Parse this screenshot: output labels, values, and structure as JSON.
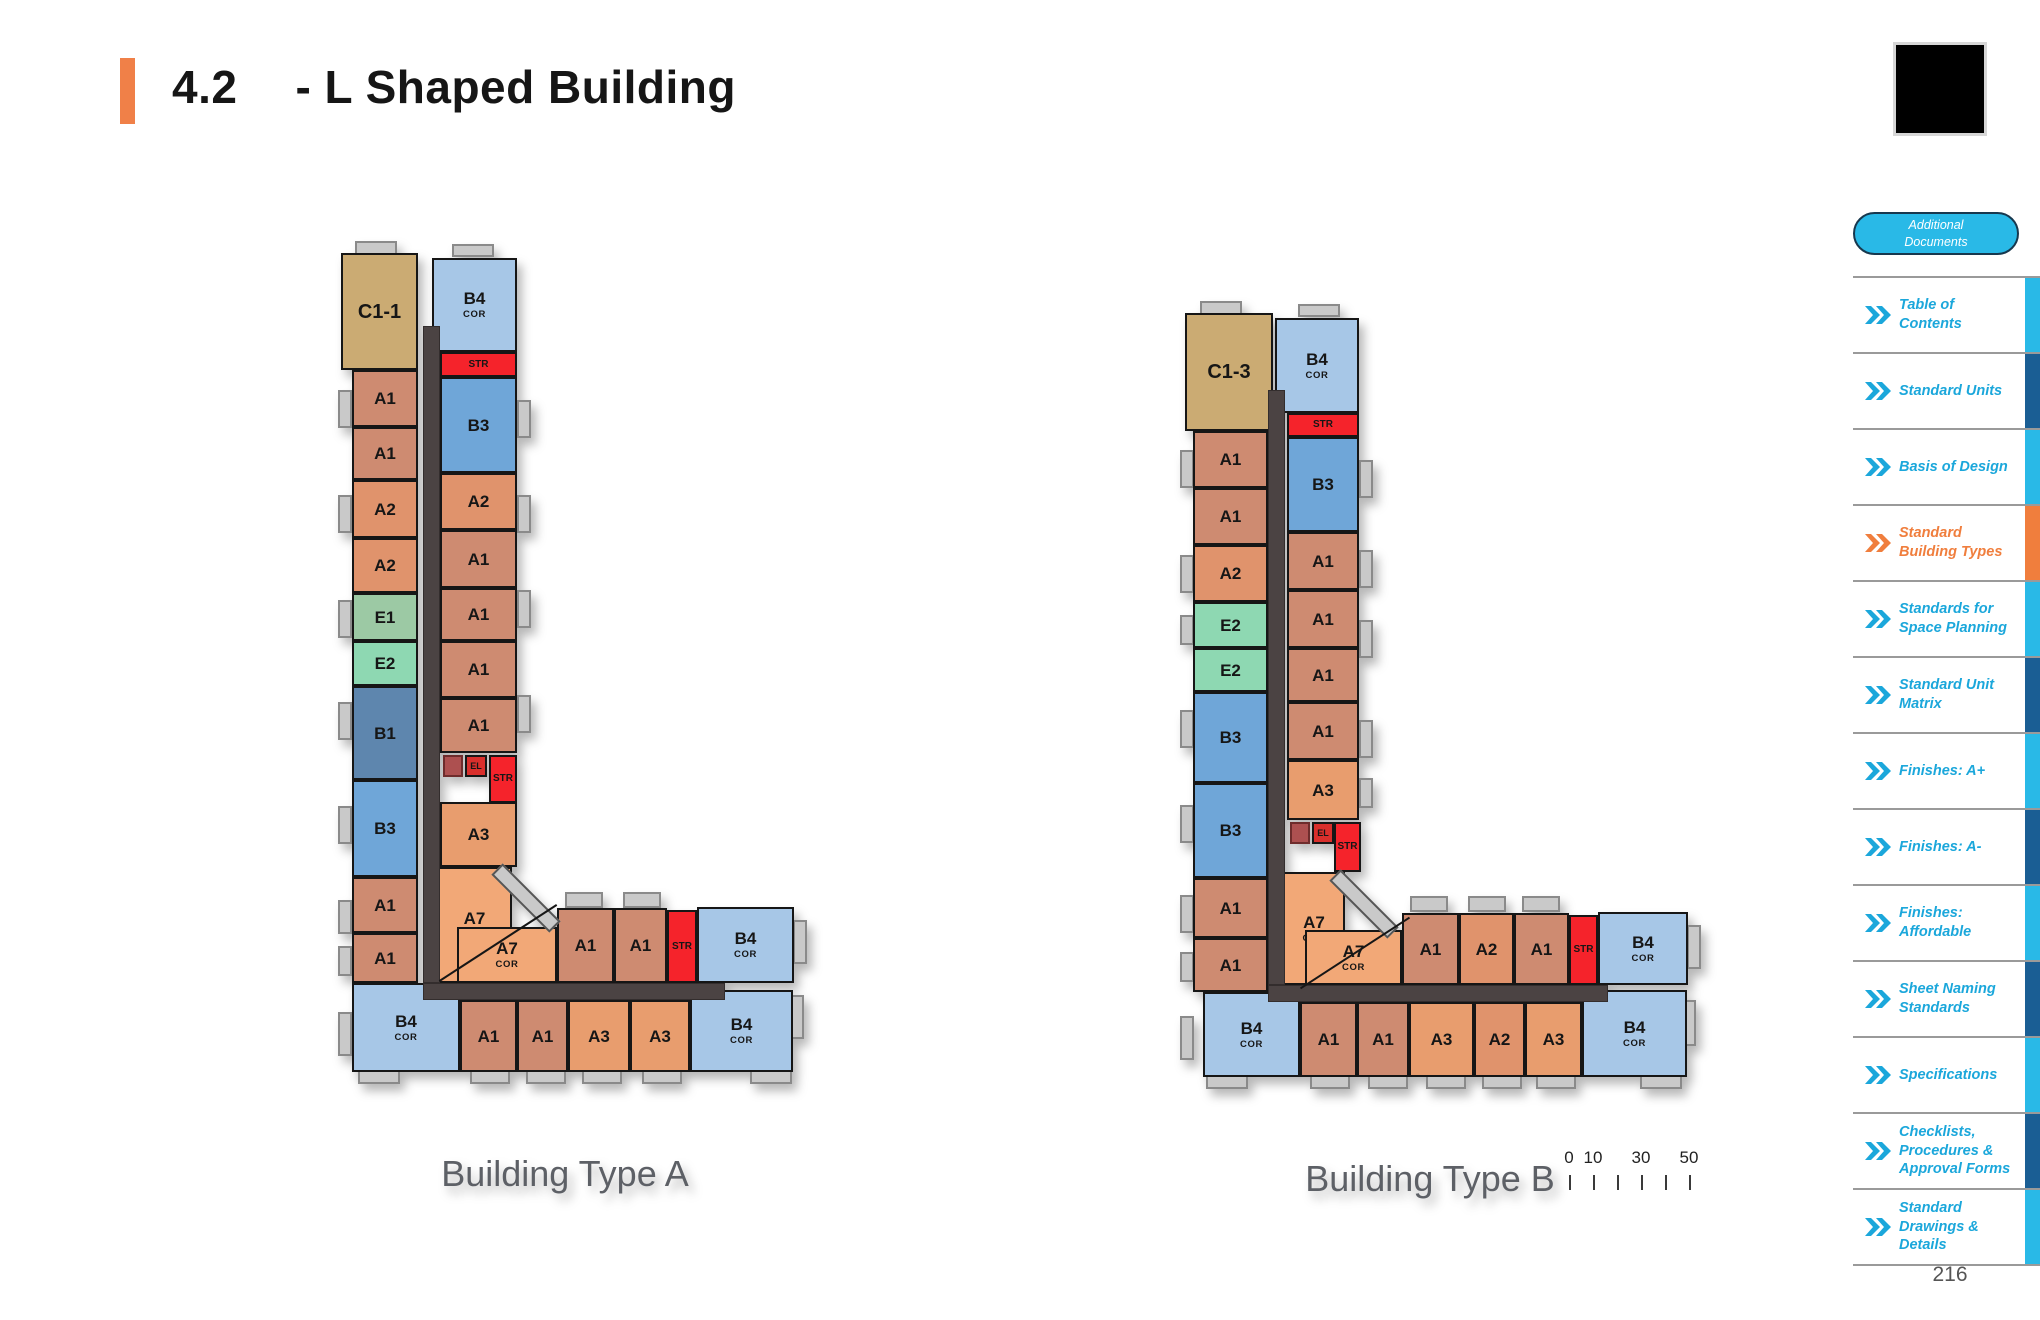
{
  "header": {
    "section": "4.2",
    "title": "- L Shaped Building"
  },
  "page_number": "216",
  "palette": {
    "A1": "#ce8b71",
    "A2": "#e0936c",
    "A3": "#e89d6e",
    "A7": "#f2a877",
    "B1": "#5e86ae",
    "B3": "#6fa6d8",
    "B4": "#a7c7e7",
    "C1": "#cbab73",
    "E1": "#9cc9a4",
    "E2": "#8ed8b2",
    "STR": "#f5232b",
    "EL": "#d92f2c",
    "ELX": "#ad5050",
    "COR": "#4b4343",
    "DECK": "#c9c9c9",
    "tab_cyan": "#29b9e7",
    "tab_dark": "#1a5e94",
    "tab_orange": "#f07e3d",
    "chev_cyan": "#1ba7db",
    "chev_orange": "#f07e3d",
    "accent": "#f08048"
  },
  "scalebar": {
    "tick_count": 6,
    "labels": [
      {
        "text": "0",
        "tick": 0
      },
      {
        "text": "10",
        "tick": 1
      },
      {
        "text": "30",
        "tick": 3
      },
      {
        "text": "50",
        "tick": 5
      }
    ]
  },
  "sidebar": {
    "pill": {
      "line1": "Additional",
      "line2": "Documents"
    },
    "items": [
      {
        "label": "Table of Contents",
        "tab": "cyan",
        "active": false
      },
      {
        "label": "Standard Units",
        "tab": "dark",
        "active": false
      },
      {
        "label": "Basis of Design",
        "tab": "cyan",
        "active": false
      },
      {
        "label": "Standard Building Types",
        "tab": "orange",
        "active": true
      },
      {
        "label": "Standards for Space Planning",
        "tab": "cyan",
        "active": false
      },
      {
        "label": "Standard Unit Matrix",
        "tab": "dark",
        "active": false
      },
      {
        "label": "Finishes: A+",
        "tab": "cyan",
        "active": false
      },
      {
        "label": "Finishes: A-",
        "tab": "dark",
        "active": false
      },
      {
        "label": "Finishes: Affordable",
        "tab": "cyan",
        "active": false
      },
      {
        "label": "Sheet Naming Standards",
        "tab": "dark",
        "active": false
      },
      {
        "label": "Specifications",
        "tab": "cyan",
        "active": false
      },
      {
        "label": "Checklists, Procedures & Approval Forms",
        "tab": "dark",
        "active": false
      },
      {
        "label": "Standard Drawings & Details",
        "tab": "cyan",
        "active": false
      }
    ]
  },
  "buildings": [
    {
      "name": "Building Type A",
      "frame": {
        "left": 330,
        "top": 240,
        "width": 470,
        "height": 835
      },
      "corridors": [
        [
          93,
          86,
          17,
          657
        ],
        [
          93,
          743,
          302,
          17
        ]
      ],
      "diagonals": [
        {
          "c": "diag-deck",
          "n": "corner-chamfer-deck",
          "x": 155,
          "y": 650,
          "w": 82,
          "h": 16,
          "r": 45
        },
        {
          "c": "diag-line",
          "n": "a7-split-line",
          "x": 98,
          "y": 702,
          "w": 140,
          "h": 2,
          "r": -33
        }
      ],
      "decks": [
        [
          8,
          150,
          14,
          38
        ],
        [
          8,
          255,
          14,
          38
        ],
        [
          8,
          360,
          14,
          38
        ],
        [
          8,
          462,
          14,
          38
        ],
        [
          8,
          566,
          14,
          38
        ],
        [
          8,
          660,
          14,
          34
        ],
        [
          8,
          706,
          14,
          30
        ],
        [
          8,
          772,
          14,
          44
        ],
        [
          187,
          160,
          14,
          38
        ],
        [
          187,
          255,
          14,
          38
        ],
        [
          187,
          350,
          14,
          38
        ],
        [
          187,
          455,
          14,
          38
        ],
        [
          235,
          652,
          38,
          16
        ],
        [
          293,
          652,
          38,
          16
        ],
        [
          140,
          830,
          40,
          14
        ],
        [
          196,
          830,
          40,
          14
        ],
        [
          252,
          830,
          40,
          14
        ],
        [
          312,
          830,
          40,
          14
        ],
        [
          25,
          1,
          42,
          14
        ],
        [
          122,
          4,
          42,
          13
        ],
        [
          463,
          680,
          14,
          44
        ],
        [
          460,
          755,
          14,
          44
        ],
        [
          28,
          830,
          42,
          14
        ],
        [
          420,
          830,
          42,
          14
        ]
      ],
      "rooms": [
        {
          "t": "C1",
          "l": "C1-1",
          "x": 11,
          "y": 13,
          "w": 77,
          "h": 117,
          "f": 20
        },
        {
          "t": "A1",
          "l": "A1",
          "x": 22,
          "y": 130,
          "w": 66,
          "h": 57
        },
        {
          "t": "A1",
          "l": "A1",
          "x": 22,
          "y": 187,
          "w": 66,
          "h": 53
        },
        {
          "t": "A2",
          "l": "A2",
          "x": 22,
          "y": 240,
          "w": 66,
          "h": 58
        },
        {
          "t": "A2",
          "l": "A2",
          "x": 22,
          "y": 298,
          "w": 66,
          "h": 55
        },
        {
          "t": "E1",
          "l": "E1",
          "x": 22,
          "y": 353,
          "w": 66,
          "h": 48
        },
        {
          "t": "E2",
          "l": "E2",
          "x": 22,
          "y": 401,
          "w": 66,
          "h": 45
        },
        {
          "t": "B1",
          "l": "B1",
          "x": 22,
          "y": 446,
          "w": 66,
          "h": 94
        },
        {
          "t": "B3",
          "l": "B3",
          "x": 22,
          "y": 540,
          "w": 66,
          "h": 97
        },
        {
          "t": "A1",
          "l": "A1",
          "x": 22,
          "y": 637,
          "w": 66,
          "h": 56
        },
        {
          "t": "A1",
          "l": "A1",
          "x": 22,
          "y": 693,
          "w": 66,
          "h": 50
        },
        {
          "t": "B4",
          "l": "B4",
          "s": "COR",
          "x": 102,
          "y": 18,
          "w": 85,
          "h": 94
        },
        {
          "t": "STR",
          "l": "STR",
          "x": 110,
          "y": 112,
          "w": 77,
          "h": 25,
          "f": 10
        },
        {
          "t": "B3",
          "l": "B3",
          "x": 110,
          "y": 137,
          "w": 77,
          "h": 96
        },
        {
          "t": "A2",
          "l": "A2",
          "x": 110,
          "y": 233,
          "w": 77,
          "h": 57
        },
        {
          "t": "A1",
          "l": "A1",
          "x": 110,
          "y": 290,
          "w": 77,
          "h": 58
        },
        {
          "t": "A1",
          "l": "A1",
          "x": 110,
          "y": 348,
          "w": 77,
          "h": 53
        },
        {
          "t": "A1",
          "l": "A1",
          "x": 110,
          "y": 401,
          "w": 77,
          "h": 57
        },
        {
          "t": "A1",
          "l": "A1",
          "x": 110,
          "y": 458,
          "w": 77,
          "h": 55
        },
        {
          "t": "ELX",
          "l": "",
          "x": 113,
          "y": 515,
          "w": 20,
          "h": 22
        },
        {
          "t": "EL",
          "l": "EL",
          "x": 135,
          "y": 515,
          "w": 22,
          "h": 22,
          "f": 9
        },
        {
          "t": "STR",
          "l": "STR",
          "x": 159,
          "y": 515,
          "w": 28,
          "h": 48,
          "f": 10
        },
        {
          "t": "A3",
          "l": "A3",
          "x": 110,
          "y": 562,
          "w": 77,
          "h": 65
        },
        {
          "t": "A7",
          "l": "A7",
          "s": "COR",
          "x": 107,
          "y": 627,
          "w": 75,
          "h": 116
        },
        {
          "t": "A7",
          "l": "A7",
          "s": "COR",
          "x": 127,
          "y": 687,
          "w": 100,
          "h": 56
        },
        {
          "t": "A1",
          "l": "A1",
          "x": 227,
          "y": 668,
          "w": 57,
          "h": 75
        },
        {
          "t": "A1",
          "l": "A1",
          "x": 284,
          "y": 668,
          "w": 53,
          "h": 75
        },
        {
          "t": "STR",
          "l": "STR",
          "x": 337,
          "y": 670,
          "w": 30,
          "h": 73,
          "f": 10
        },
        {
          "t": "B4",
          "l": "B4",
          "s": "COR",
          "x": 367,
          "y": 667,
          "w": 97,
          "h": 76
        },
        {
          "t": "B4",
          "l": "B4",
          "s": "COR",
          "x": 22,
          "y": 743,
          "w": 108,
          "h": 89
        },
        {
          "t": "A1",
          "l": "A1",
          "x": 130,
          "y": 760,
          "w": 57,
          "h": 72
        },
        {
          "t": "A1",
          "l": "A1",
          "x": 187,
          "y": 760,
          "w": 51,
          "h": 72
        },
        {
          "t": "A3",
          "l": "A3",
          "x": 238,
          "y": 760,
          "w": 62,
          "h": 72
        },
        {
          "t": "A3",
          "l": "A3",
          "x": 300,
          "y": 760,
          "w": 60,
          "h": 72
        },
        {
          "t": "B4",
          "l": "B4",
          "s": "COR",
          "x": 360,
          "y": 750,
          "w": 103,
          "h": 82
        }
      ]
    },
    {
      "name": "Building Type B",
      "frame": {
        "left": 1170,
        "top": 300,
        "width": 520,
        "height": 780
      },
      "corridors": [
        [
          98,
          90,
          17,
          595
        ],
        [
          98,
          685,
          340,
          17
        ]
      ],
      "diagonals": [
        {
          "c": "diag-deck",
          "n": "corner-chamfer-deck",
          "x": 153,
          "y": 596,
          "w": 82,
          "h": 16,
          "r": 45
        },
        {
          "c": "diag-line",
          "n": "a7-split-line",
          "x": 120,
          "y": 652,
          "w": 130,
          "h": 2,
          "r": -33
        }
      ],
      "decks": [
        [
          10,
          150,
          14,
          38
        ],
        [
          10,
          255,
          14,
          38
        ],
        [
          10,
          315,
          14,
          30
        ],
        [
          10,
          410,
          14,
          38
        ],
        [
          10,
          505,
          14,
          38
        ],
        [
          10,
          595,
          14,
          38
        ],
        [
          10,
          652,
          14,
          30
        ],
        [
          10,
          716,
          14,
          44
        ],
        [
          189,
          160,
          14,
          38
        ],
        [
          189,
          250,
          14,
          38
        ],
        [
          189,
          320,
          14,
          38
        ],
        [
          189,
          420,
          14,
          38
        ],
        [
          189,
          478,
          14,
          30
        ],
        [
          240,
          596,
          38,
          16
        ],
        [
          298,
          596,
          38,
          16
        ],
        [
          352,
          596,
          38,
          16
        ],
        [
          140,
          775,
          40,
          14
        ],
        [
          198,
          775,
          40,
          14
        ],
        [
          256,
          775,
          40,
          14
        ],
        [
          312,
          775,
          40,
          14
        ],
        [
          366,
          775,
          40,
          14
        ],
        [
          30,
          1,
          42,
          14
        ],
        [
          128,
          4,
          42,
          13
        ],
        [
          517,
          625,
          14,
          44
        ],
        [
          512,
          700,
          14,
          46
        ],
        [
          36,
          775,
          42,
          14
        ],
        [
          470,
          775,
          42,
          14
        ]
      ],
      "rooms": [
        {
          "t": "C1",
          "l": "C1-3",
          "x": 15,
          "y": 13,
          "w": 88,
          "h": 118,
          "f": 20
        },
        {
          "t": "A1",
          "l": "A1",
          "x": 23,
          "y": 131,
          "w": 75,
          "h": 57
        },
        {
          "t": "A1",
          "l": "A1",
          "x": 23,
          "y": 188,
          "w": 75,
          "h": 57
        },
        {
          "t": "A2",
          "l": "A2",
          "x": 23,
          "y": 245,
          "w": 75,
          "h": 57
        },
        {
          "t": "E2",
          "l": "E2",
          "x": 23,
          "y": 302,
          "w": 75,
          "h": 46
        },
        {
          "t": "E2",
          "l": "E2",
          "x": 23,
          "y": 348,
          "w": 75,
          "h": 44
        },
        {
          "t": "B3",
          "l": "B3",
          "x": 23,
          "y": 392,
          "w": 75,
          "h": 91
        },
        {
          "t": "B3",
          "l": "B3",
          "x": 23,
          "y": 483,
          "w": 75,
          "h": 95
        },
        {
          "t": "A1",
          "l": "A1",
          "x": 23,
          "y": 578,
          "w": 75,
          "h": 60
        },
        {
          "t": "A1",
          "l": "A1",
          "x": 23,
          "y": 638,
          "w": 75,
          "h": 54
        },
        {
          "t": "B4",
          "l": "B4",
          "s": "COR",
          "x": 105,
          "y": 18,
          "w": 84,
          "h": 95
        },
        {
          "t": "STR",
          "l": "STR",
          "x": 117,
          "y": 113,
          "w": 72,
          "h": 24,
          "f": 10
        },
        {
          "t": "B3",
          "l": "B3",
          "x": 117,
          "y": 137,
          "w": 72,
          "h": 95
        },
        {
          "t": "A1",
          "l": "A1",
          "x": 117,
          "y": 232,
          "w": 72,
          "h": 58
        },
        {
          "t": "A1",
          "l": "A1",
          "x": 117,
          "y": 290,
          "w": 72,
          "h": 58
        },
        {
          "t": "A1",
          "l": "A1",
          "x": 117,
          "y": 348,
          "w": 72,
          "h": 54
        },
        {
          "t": "A1",
          "l": "A1",
          "x": 117,
          "y": 402,
          "w": 72,
          "h": 58
        },
        {
          "t": "A3",
          "l": "A3",
          "x": 117,
          "y": 460,
          "w": 72,
          "h": 60
        },
        {
          "t": "ELX",
          "l": "",
          "x": 120,
          "y": 522,
          "w": 20,
          "h": 22
        },
        {
          "t": "EL",
          "l": "EL",
          "x": 142,
          "y": 522,
          "w": 22,
          "h": 22,
          "f": 9
        },
        {
          "t": "STR",
          "l": "STR",
          "x": 164,
          "y": 522,
          "w": 27,
          "h": 50,
          "f": 10
        },
        {
          "t": "A7",
          "l": "A7",
          "s": "COR",
          "x": 113,
          "y": 572,
          "w": 62,
          "h": 113
        },
        {
          "t": "A7",
          "l": "A7",
          "s": "COR",
          "x": 135,
          "y": 630,
          "w": 97,
          "h": 55
        },
        {
          "t": "A1",
          "l": "A1",
          "x": 232,
          "y": 613,
          "w": 57,
          "h": 72
        },
        {
          "t": "A2",
          "l": "A2",
          "x": 289,
          "y": 613,
          "w": 55,
          "h": 72
        },
        {
          "t": "A1",
          "l": "A1",
          "x": 344,
          "y": 613,
          "w": 55,
          "h": 72
        },
        {
          "t": "STR",
          "l": "STR",
          "x": 399,
          "y": 615,
          "w": 29,
          "h": 70,
          "f": 10
        },
        {
          "t": "B4",
          "l": "B4",
          "s": "COR",
          "x": 428,
          "y": 612,
          "w": 90,
          "h": 73
        },
        {
          "t": "B4",
          "l": "B4",
          "s": "COR",
          "x": 33,
          "y": 692,
          "w": 97,
          "h": 85
        },
        {
          "t": "A1",
          "l": "A1",
          "x": 130,
          "y": 702,
          "w": 57,
          "h": 75
        },
        {
          "t": "A1",
          "l": "A1",
          "x": 187,
          "y": 702,
          "w": 52,
          "h": 75
        },
        {
          "t": "A3",
          "l": "A3",
          "x": 239,
          "y": 702,
          "w": 65,
          "h": 75
        },
        {
          "t": "A2",
          "l": "A2",
          "x": 304,
          "y": 702,
          "w": 51,
          "h": 75
        },
        {
          "t": "A3",
          "l": "A3",
          "x": 355,
          "y": 702,
          "w": 57,
          "h": 75
        },
        {
          "t": "B4",
          "l": "B4",
          "s": "COR",
          "x": 412,
          "y": 690,
          "w": 105,
          "h": 87
        }
      ]
    }
  ]
}
